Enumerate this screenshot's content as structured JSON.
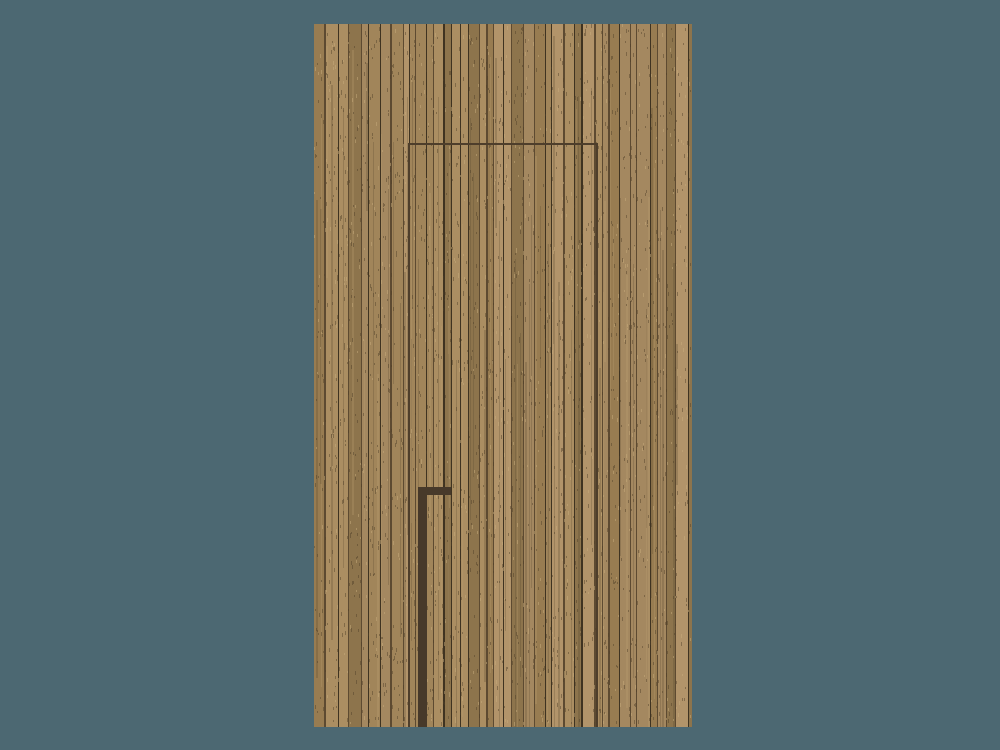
{
  "scene": {
    "width": 1000,
    "height": 750,
    "background_color": "#4c6872",
    "panel": {
      "x": 314,
      "y": 24,
      "width": 378,
      "height": 703,
      "base_color": "#a0845a"
    },
    "wood": {
      "seed": 42,
      "plank_min_width": 5,
      "plank_max_width": 13,
      "plank_colors": [
        "#ab8e62",
        "#a1855a",
        "#987c51",
        "#8d744c",
        "#b2946a",
        "#a48860"
      ],
      "gap_color": "#5d4a31",
      "gap_dark_color": "#3f3321",
      "streak_dark": "#55432c",
      "streak_light": "#c0a173",
      "speckle_dark": "#4e3d27",
      "speckle_light": "#c8ab7c",
      "speckle_count": 2600
    },
    "door_groove": {
      "left_x": 408,
      "right_x": 596,
      "top_y": 143,
      "thickness": 2,
      "color": "#4e3e2b"
    },
    "handle": {
      "color": "#47392a",
      "horizontal": {
        "x": 418,
        "y": 487,
        "width": 33,
        "height": 8
      },
      "vertical": {
        "x": 418,
        "y": 487,
        "width": 9
      }
    }
  }
}
